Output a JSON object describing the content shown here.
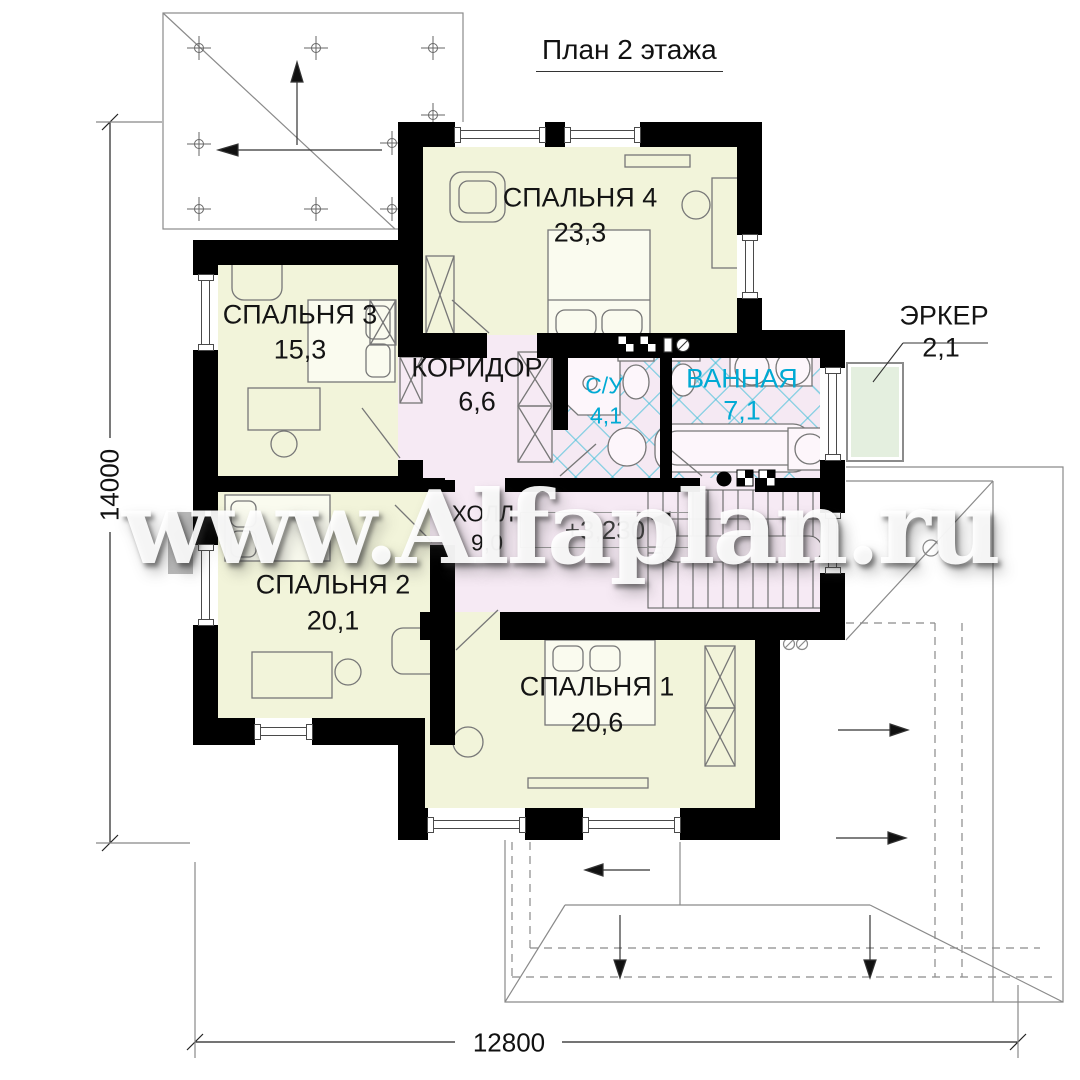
{
  "title": "План 2 этажа",
  "watermark": "www.Alfaplan.ru",
  "rooms": {
    "bedroom4": {
      "label": "СПАЛЬНЯ 4",
      "area": "23,3"
    },
    "bedroom3": {
      "label": "СПАЛЬНЯ 3",
      "area": "15,3"
    },
    "corridor": {
      "label": "КОРИДОР",
      "area": "6,6"
    },
    "wc": {
      "label": "С/У",
      "area": "4,1"
    },
    "bathroom": {
      "label": "ВАННАЯ",
      "area": "7,1"
    },
    "bay": {
      "label": "ЭРКЕР",
      "area": "2,1"
    },
    "hall": {
      "label": "ХОЛЛ",
      "area": "9,0"
    },
    "bedroom2": {
      "label": "СПАЛЬНЯ 2",
      "area": "20,1"
    },
    "bedroom1": {
      "label": "СПАЛЬНЯ 1",
      "area": "20,6"
    }
  },
  "annotations": {
    "level_mark": "+3,230"
  },
  "dimensions": {
    "height_total": "14000",
    "width_total": "12800"
  },
  "colors": {
    "room_fill": "#f2f4da",
    "hall_fill": "#f6eaf4",
    "tile_accent": "#3cbed7",
    "bay_fill": "#e4efdf",
    "wet_label_text": "#00aad4",
    "wall": "#000000"
  }
}
